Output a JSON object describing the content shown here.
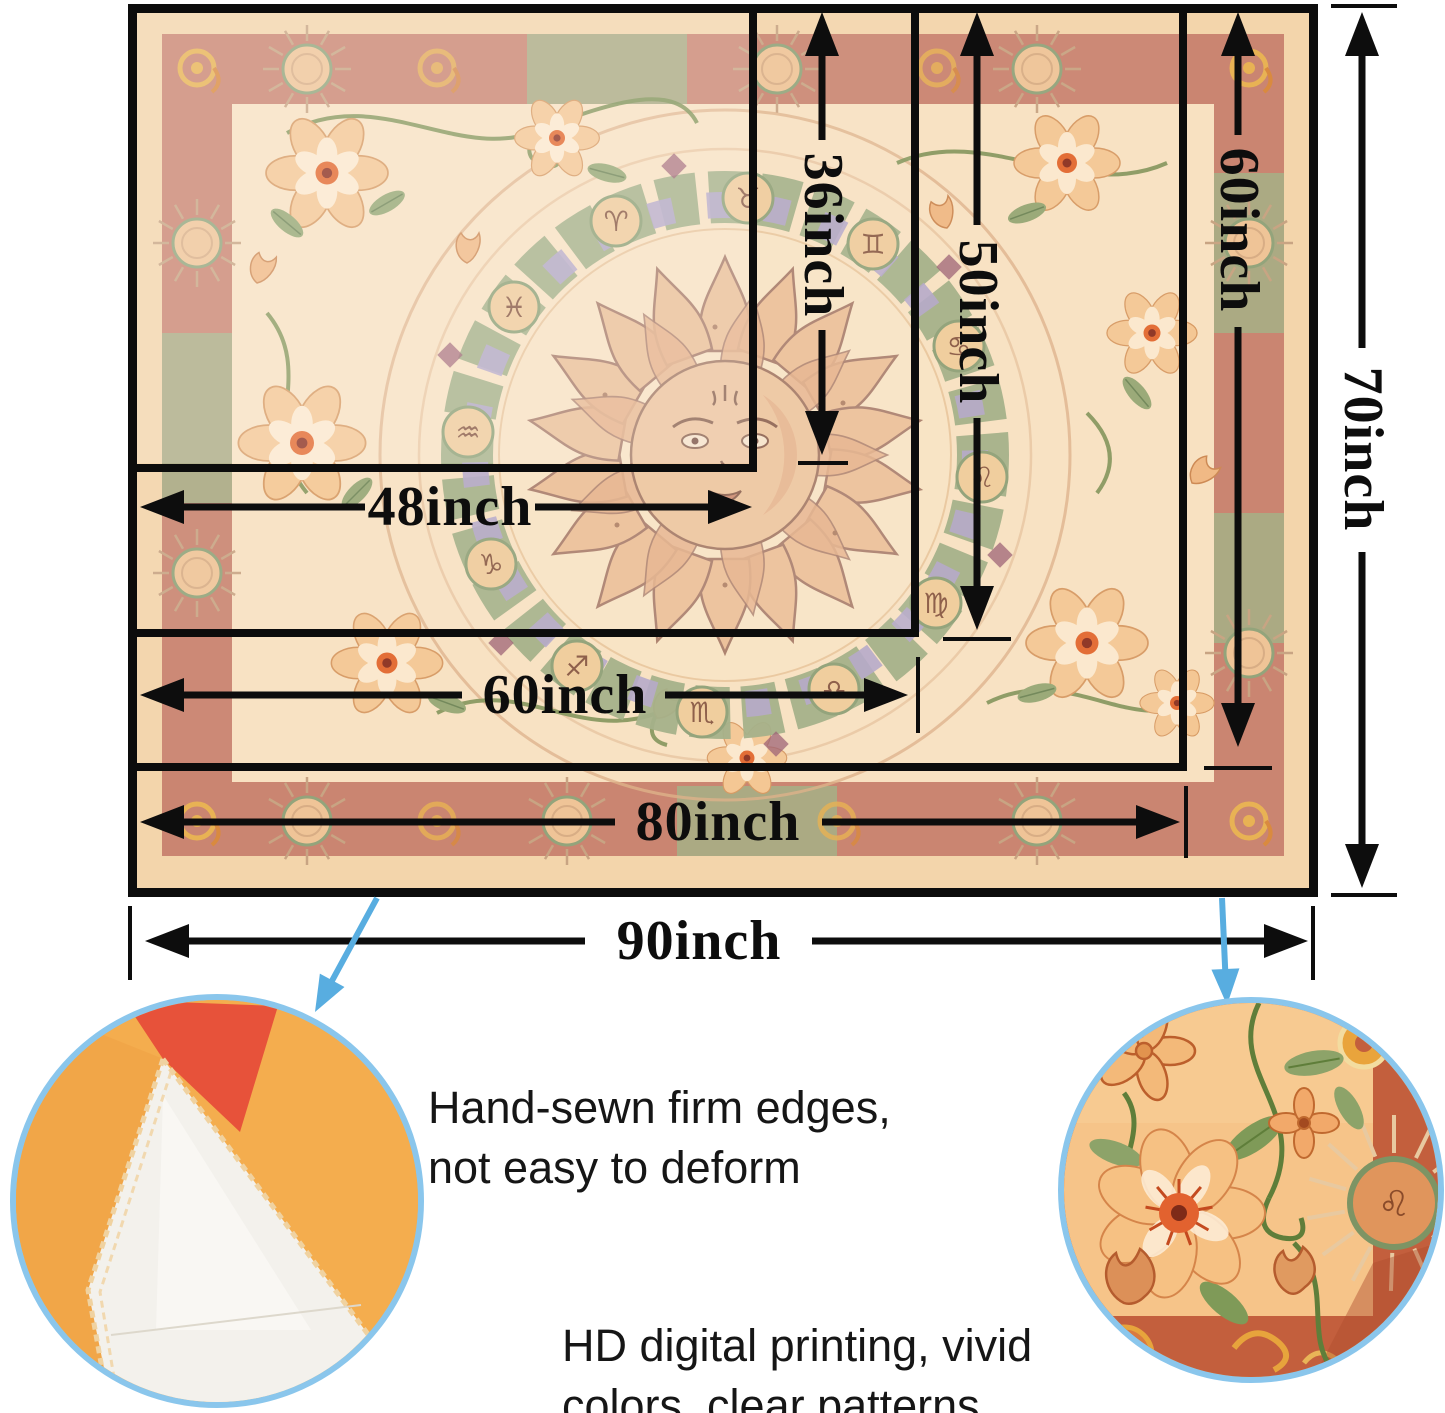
{
  "sizes": [
    {
      "width_label": "48inch",
      "height_label": "36inch"
    },
    {
      "width_label": "60inch",
      "height_label": "50inch"
    },
    {
      "width_label": "80inch",
      "height_label": "60inch"
    },
    {
      "width_label": "90inch",
      "height_label": "70inch"
    }
  ],
  "features": {
    "stitching_line1": "Hand-sewn firm edges,",
    "stitching_line2": "not easy to deform",
    "printing_line1": "HD digital printing, vivid",
    "printing_line2": "colors, clear patterns"
  },
  "zodiac": [
    "♈",
    "♉",
    "♊",
    "♋",
    "♌",
    "♍",
    "♎",
    "♏",
    "♐",
    "♑",
    "♒",
    "♓"
  ],
  "colors": {
    "dimension_ink": "#0d0d0d",
    "callout_blue": "#58ade0",
    "circle_ring_blue": "#8ac6ec",
    "tapestry_margin": "#f3d5ab",
    "border_band": "#ca8571",
    "inner_field": "#f8e1c1",
    "feature_text": "#161616"
  }
}
